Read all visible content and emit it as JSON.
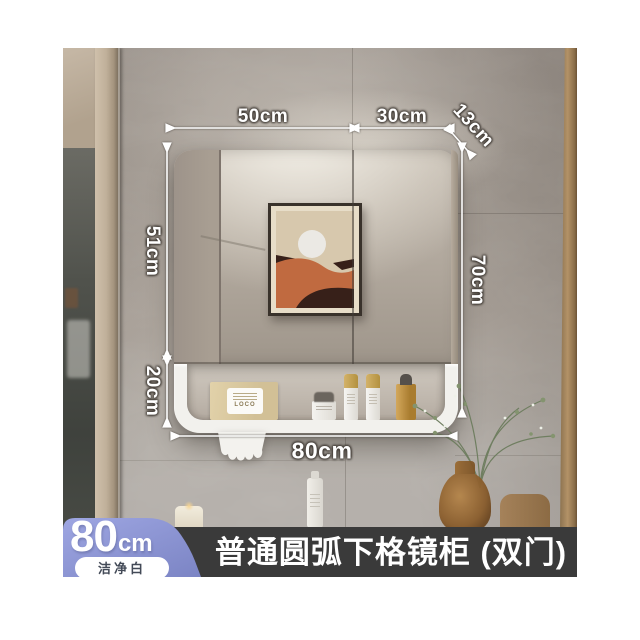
{
  "badge": {
    "size_value": "80",
    "size_unit": "cm",
    "finish_label": "洁净白",
    "bg_color": "#8b93d3"
  },
  "banner": {
    "title": "普通圆弧下格镜柜 (双门)",
    "bg_color": "#3a3a3a"
  },
  "dimensions": {
    "door_left_width": "50cm",
    "door_right_width": "30cm",
    "depth": "13cm",
    "mirror_height": "51cm",
    "shelf_height": "20cm",
    "overall_height": "70cm",
    "overall_width": "80cm"
  },
  "scene": {
    "tissue_box_brand": "LOCO"
  }
}
